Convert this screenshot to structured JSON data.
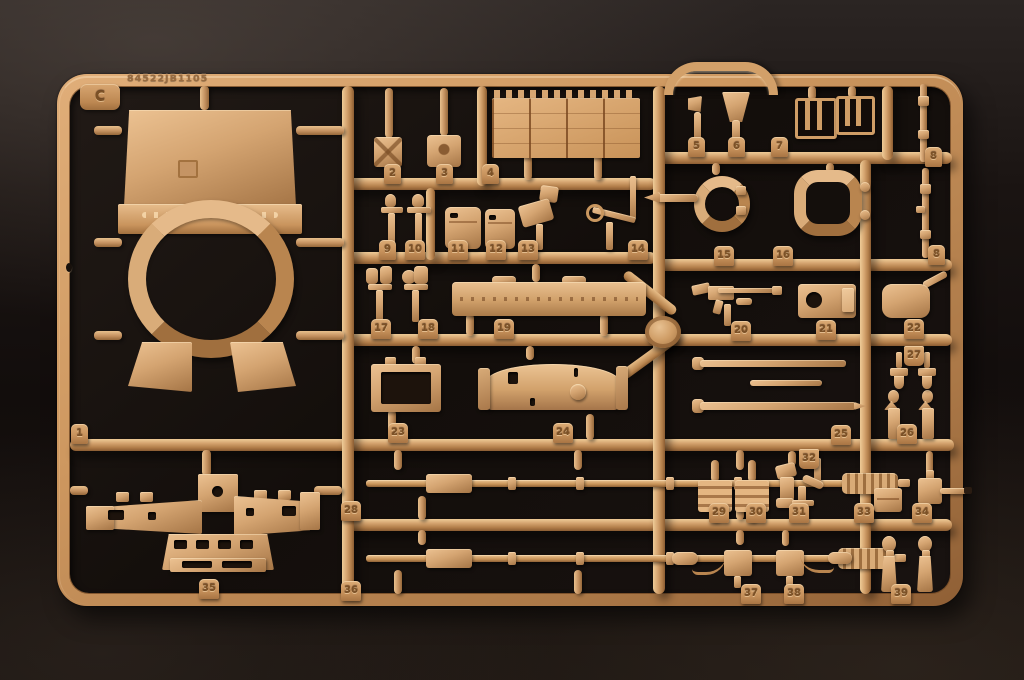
{
  "sprue": {
    "letter": "C",
    "mold_code": "84522JB1105",
    "palette": {
      "plastic_base": "#cd975f",
      "plastic_light": "#eecb97",
      "plastic_dark": "#8a5c32",
      "background_dark": "#130e0b",
      "background_edge": "#2b2523"
    },
    "part_tags": [
      {
        "label": "1",
        "x": 71,
        "y": 424
      },
      {
        "label": "2",
        "x": 384,
        "y": 164
      },
      {
        "label": "3",
        "x": 436,
        "y": 164
      },
      {
        "label": "4",
        "x": 482,
        "y": 164
      },
      {
        "label": "5",
        "x": 688,
        "y": 137
      },
      {
        "label": "6",
        "x": 728,
        "y": 137
      },
      {
        "label": "7",
        "x": 771,
        "y": 137
      },
      {
        "label": "8",
        "x": 925,
        "y": 147
      },
      {
        "label": "8",
        "x": 928,
        "y": 245
      },
      {
        "label": "9",
        "x": 379,
        "y": 240
      },
      {
        "label": "10",
        "x": 405,
        "y": 240
      },
      {
        "label": "11",
        "x": 448,
        "y": 240
      },
      {
        "label": "12",
        "x": 486,
        "y": 240
      },
      {
        "label": "13",
        "x": 518,
        "y": 240
      },
      {
        "label": "14",
        "x": 628,
        "y": 240
      },
      {
        "label": "15",
        "x": 714,
        "y": 246
      },
      {
        "label": "16",
        "x": 773,
        "y": 246
      },
      {
        "label": "17",
        "x": 371,
        "y": 319
      },
      {
        "label": "18",
        "x": 418,
        "y": 319
      },
      {
        "label": "19",
        "x": 494,
        "y": 319
      },
      {
        "label": "20",
        "x": 731,
        "y": 321
      },
      {
        "label": "21",
        "x": 816,
        "y": 320
      },
      {
        "label": "22",
        "x": 904,
        "y": 319
      },
      {
        "label": "23",
        "x": 388,
        "y": 423
      },
      {
        "label": "24",
        "x": 553,
        "y": 423
      },
      {
        "label": "25",
        "x": 831,
        "y": 425
      },
      {
        "label": "26",
        "x": 897,
        "y": 424
      },
      {
        "label": "27",
        "x": 904,
        "y": 346,
        "variant": "hang"
      },
      {
        "label": "28",
        "x": 341,
        "y": 501
      },
      {
        "label": "29",
        "x": 709,
        "y": 503
      },
      {
        "label": "30",
        "x": 746,
        "y": 503
      },
      {
        "label": "31",
        "x": 789,
        "y": 503
      },
      {
        "label": "32",
        "x": 799,
        "y": 449,
        "variant": "hang"
      },
      {
        "label": "33",
        "x": 854,
        "y": 503
      },
      {
        "label": "34",
        "x": 912,
        "y": 503
      },
      {
        "label": "35",
        "x": 199,
        "y": 579
      },
      {
        "label": "36",
        "x": 341,
        "y": 581
      },
      {
        "label": "37",
        "x": 741,
        "y": 584
      },
      {
        "label": "38",
        "x": 784,
        "y": 584
      },
      {
        "label": "39",
        "x": 891,
        "y": 584
      }
    ]
  }
}
